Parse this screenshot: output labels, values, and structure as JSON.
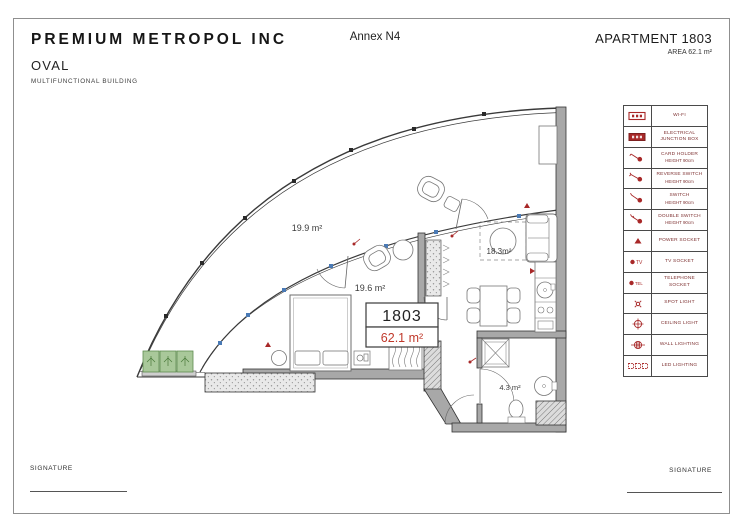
{
  "header": {
    "company": "PREMIUM METROPOL INC",
    "project_name": "OVAL",
    "project_type": "MULTIFUNCTIONAL BUILDING",
    "annex": "Annex N4",
    "apartment": "APARTMENT 1803",
    "area": "AREA 62.1 m²"
  },
  "plan": {
    "rooms": [
      {
        "name": "terrace",
        "area_label": "19.9 m²"
      },
      {
        "name": "bedroom",
        "area_label": "19.6 m²"
      },
      {
        "name": "living-kitchen",
        "area_label": "18.3m²"
      },
      {
        "name": "bathroom",
        "area_label": "4.3 m²"
      }
    ],
    "badge": {
      "number": "1803",
      "area": "62.1 m²"
    }
  },
  "legend": {
    "items": [
      {
        "icon": "wifi",
        "label": "WI-FI",
        "sub": ""
      },
      {
        "icon": "junction-box",
        "label": "ELECTRICAL JUNCTION BOX",
        "sub": ""
      },
      {
        "icon": "card-holder",
        "label": "CARD HOLDER",
        "sub": "HEIGHT 90cm"
      },
      {
        "icon": "reverse-switch",
        "label": "REVERSE SWITCH",
        "sub": "HEIGHT 90cm"
      },
      {
        "icon": "switch",
        "label": "SWITCH",
        "sub": "HEIGHT 90cm"
      },
      {
        "icon": "double-switch",
        "label": "DOUBLE SWITCH",
        "sub": "HEIGHT 90cm"
      },
      {
        "icon": "power-socket",
        "label": "POWER SOCKET",
        "sub": ""
      },
      {
        "icon": "tv-socket",
        "label": "TV SOCKET",
        "sub": ""
      },
      {
        "icon": "telephone-socket",
        "label": "TELEPHONE SOCKET",
        "sub": ""
      },
      {
        "icon": "spot-light",
        "label": "SPOT LIGHT",
        "sub": ""
      },
      {
        "icon": "ceiling-light",
        "label": "CEILING LIGHT",
        "sub": ""
      },
      {
        "icon": "wall-lighting",
        "label": "WALL LIGHTING",
        "sub": ""
      },
      {
        "icon": "led-lighting",
        "label": "LED LIGHTING",
        "sub": ""
      }
    ]
  },
  "footer": {
    "signature_left": "SIGNATURE",
    "signature_right": "SIGNATURE"
  },
  "colors": {
    "legend_red": "#a82828",
    "area_red": "#c0392b",
    "planter_green": "#a9c89a",
    "window_blue": "#4a7ab5"
  }
}
